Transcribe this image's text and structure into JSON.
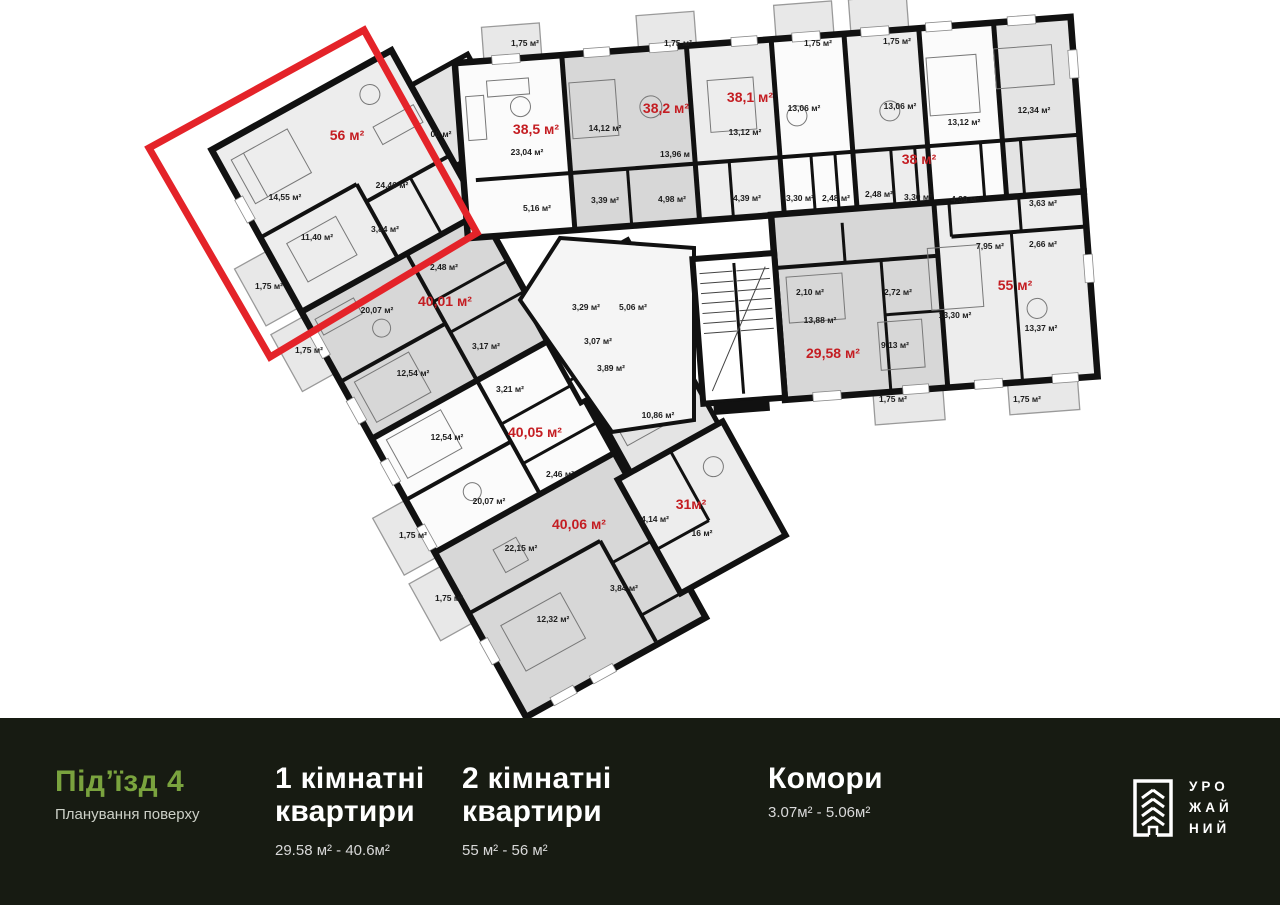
{
  "plan": {
    "label_color": "#c41d22",
    "highlight": {
      "apartment": "56 м²",
      "color": "#e42329"
    },
    "apartment_labels": [
      {
        "t": "56 м²",
        "x": 347,
        "y": 140,
        "s": 15
      },
      {
        "t": "38,5 м²",
        "x": 536,
        "y": 134,
        "s": 15
      },
      {
        "t": "38,2 м²",
        "x": 666,
        "y": 113
      },
      {
        "t": "38,1 м²",
        "x": 750,
        "y": 102
      },
      {
        "t": "38 м²",
        "x": 919,
        "y": 164,
        "s": 13
      },
      {
        "t": "55 м²",
        "x": 1015,
        "y": 290
      },
      {
        "t": "29,58 м²",
        "x": 833,
        "y": 358,
        "s": 13
      },
      {
        "t": "40,01 м²",
        "x": 445,
        "y": 306
      },
      {
        "t": "40,05 м²",
        "x": 535,
        "y": 437
      },
      {
        "t": "40,06 м²",
        "x": 579,
        "y": 529
      },
      {
        "t": "31м²",
        "x": 691,
        "y": 509
      }
    ],
    "room_labels": [
      {
        "t": "14,55 м²",
        "x": 285,
        "y": 200
      },
      {
        "t": "24,46 м²",
        "x": 392,
        "y": 188
      },
      {
        "t": "11,40 м²",
        "x": 317,
        "y": 240
      },
      {
        "t": "3,84 м²",
        "x": 385,
        "y": 232
      },
      {
        "t": "1,75 м²",
        "x": 269,
        "y": 289
      },
      {
        "t": "1,75 м²",
        "x": 309,
        "y": 353
      },
      {
        "t": "00 м²",
        "x": 441,
        "y": 137
      },
      {
        "t": "1,75 м²",
        "x": 525,
        "y": 46
      },
      {
        "t": "23,04 м²",
        "x": 527,
        "y": 155
      },
      {
        "t": "5,16 м²",
        "x": 537,
        "y": 211
      },
      {
        "t": "1,75 м²",
        "x": 678,
        "y": 46
      },
      {
        "t": "14,12 м²",
        "x": 605,
        "y": 131
      },
      {
        "t": "13,96 м",
        "x": 675,
        "y": 157
      },
      {
        "t": "3,39 м²",
        "x": 605,
        "y": 203
      },
      {
        "t": "4,98 м²",
        "x": 672,
        "y": 202
      },
      {
        "t": "13,12 м²",
        "x": 745,
        "y": 135
      },
      {
        "t": "4,39 м²",
        "x": 747,
        "y": 201
      },
      {
        "t": "1,75 м²",
        "x": 818,
        "y": 46
      },
      {
        "t": "13,06 м²",
        "x": 804,
        "y": 111
      },
      {
        "t": "3,30 м²",
        "x": 800,
        "y": 201
      },
      {
        "t": "2,48 м²",
        "x": 836,
        "y": 201
      },
      {
        "t": "1,75 м²",
        "x": 897,
        "y": 44
      },
      {
        "t": "13,06 м²",
        "x": 900,
        "y": 109
      },
      {
        "t": "2,48 м²",
        "x": 879,
        "y": 197
      },
      {
        "t": "3,30 м²",
        "x": 918,
        "y": 200
      },
      {
        "t": "13,12 м²",
        "x": 964,
        "y": 125
      },
      {
        "t": "4,39 м²",
        "x": 965,
        "y": 202
      },
      {
        "t": "12,34 м²",
        "x": 1034,
        "y": 113
      },
      {
        "t": "3,63 м²",
        "x": 1043,
        "y": 206
      },
      {
        "t": "7,95 м²",
        "x": 990,
        "y": 249
      },
      {
        "t": "2,66 м²",
        "x": 1043,
        "y": 247
      },
      {
        "t": "2,10 м²",
        "x": 810,
        "y": 295
      },
      {
        "t": "2,72 м²",
        "x": 898,
        "y": 295
      },
      {
        "t": "13,88 м²",
        "x": 820,
        "y": 323
      },
      {
        "t": "13,30 м²",
        "x": 955,
        "y": 318
      },
      {
        "t": "13,37 м²",
        "x": 1041,
        "y": 331
      },
      {
        "t": "9,13 м²",
        "x": 895,
        "y": 348
      },
      {
        "t": "1,75 м²",
        "x": 893,
        "y": 402
      },
      {
        "t": "1,75 м²",
        "x": 1027,
        "y": 402
      },
      {
        "t": "3,29 м²",
        "x": 586,
        "y": 310
      },
      {
        "t": "5,06 м²",
        "x": 633,
        "y": 310
      },
      {
        "t": "3,07 м²",
        "x": 598,
        "y": 344
      },
      {
        "t": "3,89 м²",
        "x": 611,
        "y": 371
      },
      {
        "t": "10,86 м²",
        "x": 658,
        "y": 418
      },
      {
        "t": "20,07 м²",
        "x": 377,
        "y": 313
      },
      {
        "t": "2,48 м²",
        "x": 444,
        "y": 270
      },
      {
        "t": "3,17 м²",
        "x": 486,
        "y": 349
      },
      {
        "t": "12,54 м²",
        "x": 413,
        "y": 376
      },
      {
        "t": "3,21 м²",
        "x": 510,
        "y": 392
      },
      {
        "t": "12,54 м²",
        "x": 447,
        "y": 440
      },
      {
        "t": "20,07 м²",
        "x": 489,
        "y": 504
      },
      {
        "t": "2,46 м²",
        "x": 560,
        "y": 477
      },
      {
        "t": "1,75 м²",
        "x": 413,
        "y": 538
      },
      {
        "t": "22,15 м²",
        "x": 521,
        "y": 551
      },
      {
        "t": "12,32 м²",
        "x": 553,
        "y": 622
      },
      {
        "t": "3,84 м²",
        "x": 624,
        "y": 591
      },
      {
        "t": "1,75 м²",
        "x": 449,
        "y": 601
      },
      {
        "t": "4,14 м²",
        "x": 655,
        "y": 522
      },
      {
        "t": "16 м²",
        "x": 702,
        "y": 536
      }
    ]
  },
  "footer": {
    "background": "#171b12",
    "accent_green": "#7aa33e",
    "entrance": {
      "title": "Під’їзд 4",
      "subtitle": "Планування поверху"
    },
    "columns": [
      {
        "l1": "1 кімнатні",
        "l2": "квартири",
        "range": "29.58 м² - 40.6м²"
      },
      {
        "l1": "2 кімнатні",
        "l2": "квартири",
        "range": "55 м² - 56 м²"
      },
      {
        "l1": "Комори",
        "l2": "",
        "range": "3.07м² - 5.06м²"
      }
    ],
    "logo": {
      "lines": [
        "УРО",
        "ЖАЙ",
        "НИЙ"
      ]
    }
  }
}
